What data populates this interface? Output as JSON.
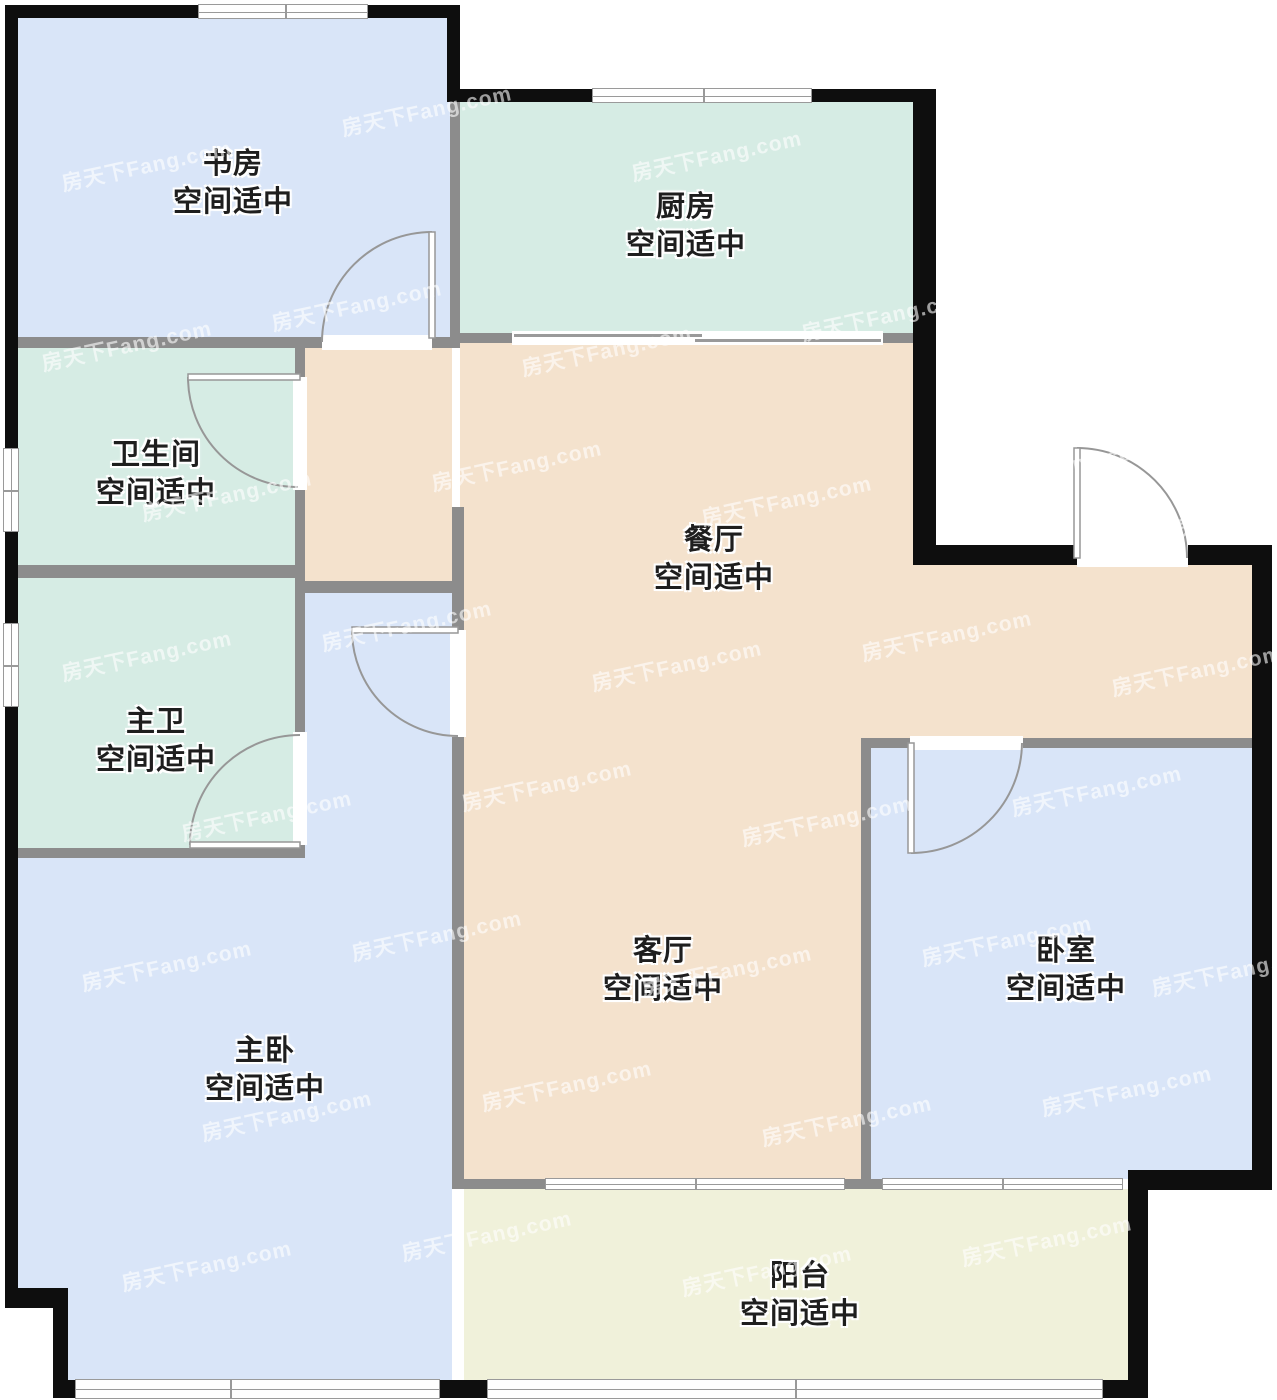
{
  "watermark": {
    "text": "房天下Fang.com"
  },
  "rooms": [
    {
      "id": "study",
      "name": "书房",
      "note": "空间适中"
    },
    {
      "id": "kitchen",
      "name": "厨房",
      "note": "空间适中"
    },
    {
      "id": "bathroom",
      "name": "卫生间",
      "note": "空间适中"
    },
    {
      "id": "dining",
      "name": "餐厅",
      "note": "空间适中"
    },
    {
      "id": "master-bath",
      "name": "主卫",
      "note": "空间适中"
    },
    {
      "id": "master-bedroom",
      "name": "主卧",
      "note": "空间适中"
    },
    {
      "id": "living-room",
      "name": "客厅",
      "note": "空间适中"
    },
    {
      "id": "bedroom",
      "name": "卧室",
      "note": "空间适中"
    },
    {
      "id": "balcony",
      "name": "阳台",
      "note": "空间适中"
    }
  ],
  "colors": {
    "room_blue": "#d9e5f8",
    "room_green": "#d6ece4",
    "room_beige": "#f4e2cd",
    "room_yellow": "#f0f1da",
    "exterior_wall": "#0e0e0e",
    "interior_wall": "#8c8c8c",
    "door_stroke": "#979797"
  }
}
